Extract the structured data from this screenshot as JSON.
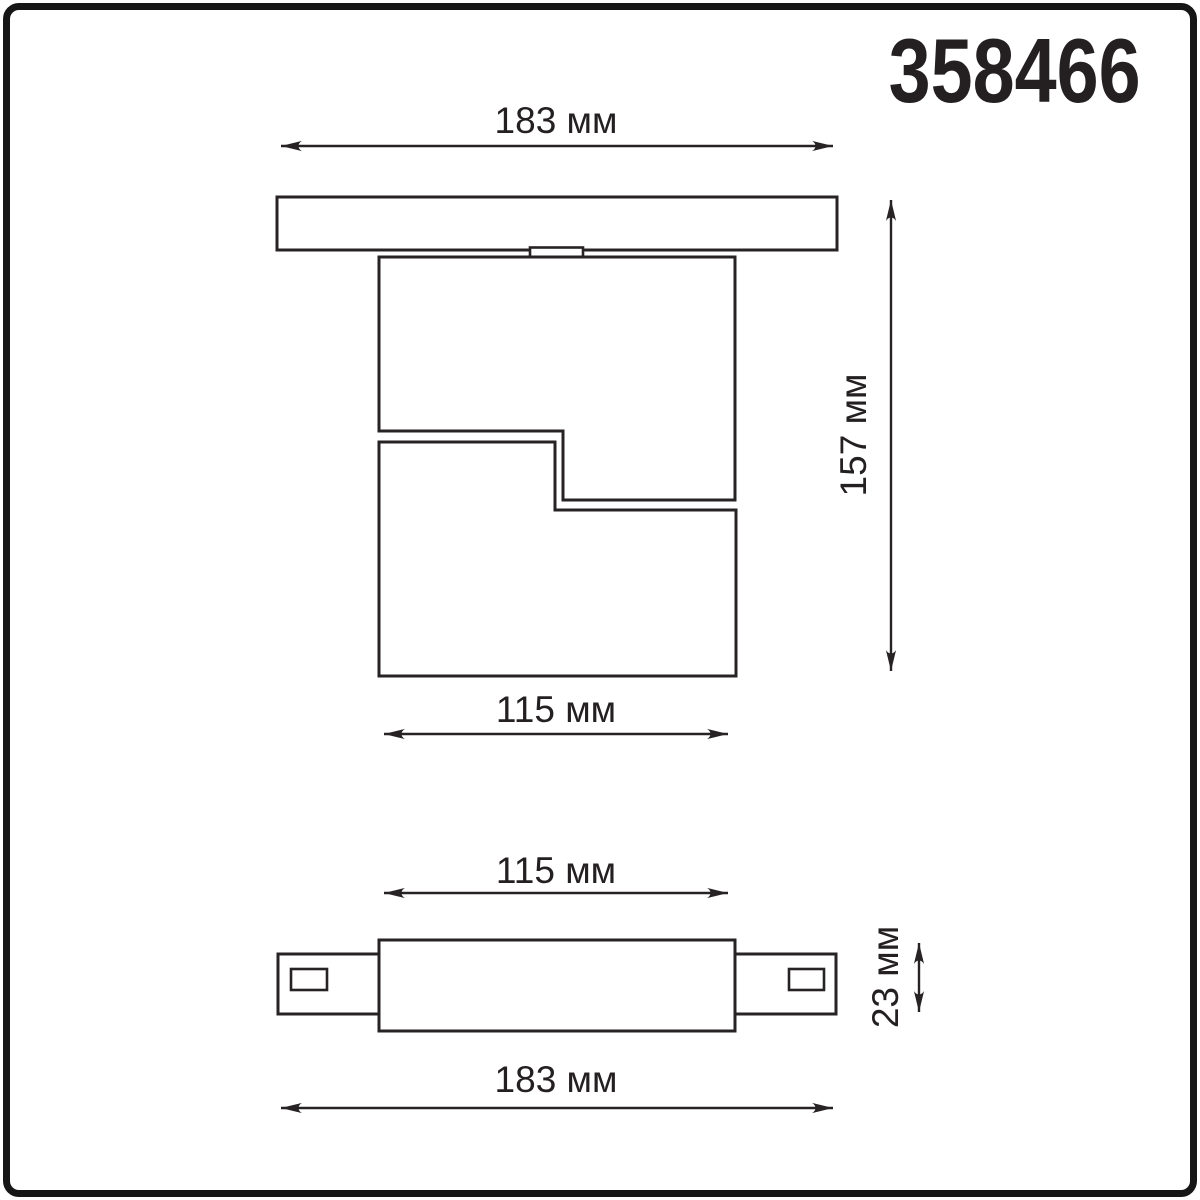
{
  "article": "358466",
  "units": "мм",
  "colors": {
    "background": "#ffffff",
    "line": "#272324",
    "frame": "#161616",
    "text": "#242021"
  },
  "front_view": {
    "description": "track-mounted swivel luminaire, front elevation",
    "dimensions": {
      "width_top": "183 мм",
      "height_right": "157 мм",
      "width_bottom": "115 мм"
    }
  },
  "side_view": {
    "description": "track adapter profile, side elevation",
    "dimensions": {
      "width_top": "115 мм",
      "height_right": "23 мм",
      "width_bottom": "183 мм"
    }
  }
}
